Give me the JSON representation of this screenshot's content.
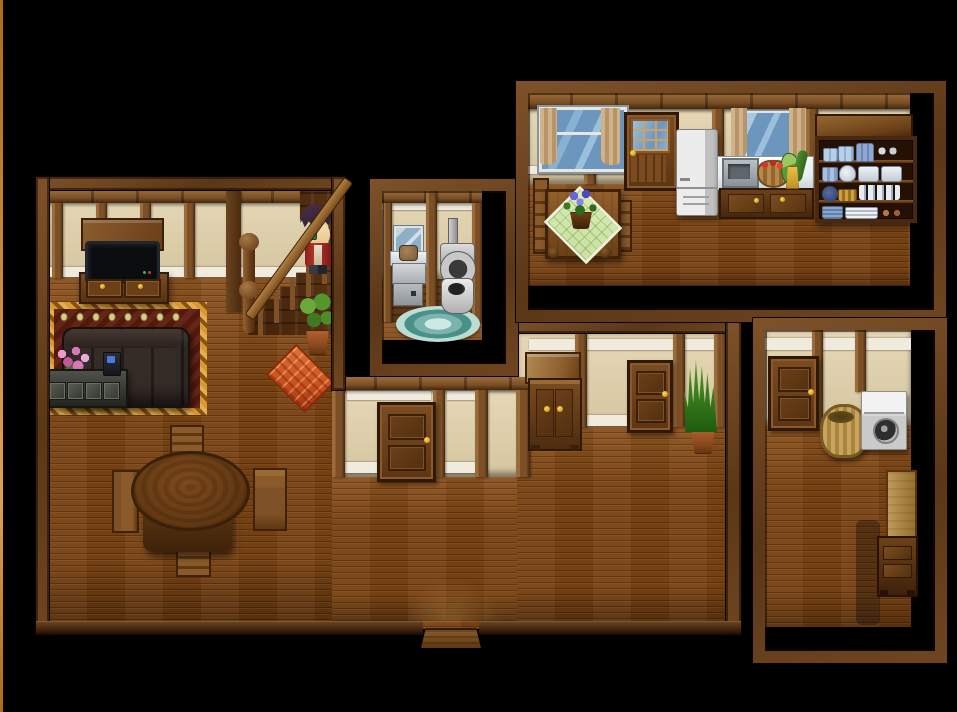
{
  "scene": {
    "type": "rpg-top-down-interior",
    "description": "Top-down RPG house interior map on black void: living room with staircase and character, small bathroom, kitchen, hallway room and laundry room",
    "character": {
      "name": "hero",
      "facing": "left",
      "hair_color": "#3f2a3c",
      "jacket_color": "#ab2d26",
      "skin_color": "#efcf9e",
      "eye_color": "#3f9a50",
      "location": "top-of-staircase"
    }
  },
  "palette": {
    "floor": "#7a4313",
    "floor_hi": "#8d5420",
    "wall": "#e6d8b6",
    "wall_dark": "#d5c6a1",
    "stripe": "#f0ebdc",
    "beam": "#7b5026",
    "beam_hi": "#9a6c3a",
    "beam_dark": "#46280e",
    "frame_hi": "#7e5229",
    "frame_mid": "#5a3718",
    "frame_low": "#6f4520",
    "wainscot": "#5c3716",
    "bath_floor": "#8a5526",
    "edge_strip": "#d0893a",
    "rug_gold": "#c8891f",
    "rug_red": "#5e1d10",
    "rug_motif": "#d9ca8b",
    "diamond_rug": "#c85020",
    "couch": "#2c2522",
    "tv_screen": "#0b0c10",
    "window_glass": "#6d96bf",
    "curtain": "#c9a97e",
    "appliance_white": "#d9d9d9",
    "counter_white": "#e9eef2",
    "teal_rug": "#4f948c",
    "wicker": "#c1a05f",
    "mat_green": "#c8e0a0",
    "plant_green": "#55952e",
    "gold": "#e8b52a"
  },
  "rooms": [
    {
      "id": "living-room",
      "label": "living room",
      "furniture": [
        "tv-hutch",
        "television",
        "tv-stand",
        "ornate-rug",
        "sofa",
        "pink-flower-planter",
        "drawer-cabinet",
        "radio-device",
        "staircase",
        "banister",
        "newel-post",
        "hero-character",
        "potted-bush",
        "diamond-rug",
        "round-dining-table",
        "dining-chair",
        "dining-chair",
        "dining-chair",
        "dining-chair"
      ]
    },
    {
      "id": "bathroom",
      "label": "bathroom",
      "furniture": [
        "mirror",
        "washbasin",
        "vanity-cabinet",
        "toilet",
        "oval-bath-rug"
      ]
    },
    {
      "id": "kitchen",
      "label": "kitchen",
      "furniture": [
        "window-left",
        "curtains",
        "flower-cart-table",
        "green-quilt-mat",
        "blue-flower-pot",
        "glass-pane-door",
        "refrigerator",
        "sink-counter",
        "kitchen-sink",
        "tomato-basket",
        "vegetables",
        "dish-shelf"
      ]
    },
    {
      "id": "hallway-room",
      "label": "middle hallway room",
      "furniture": [
        "hall-door",
        "junction-crate",
        "hall-cabinet",
        "snake-plant",
        "floor-step"
      ]
    },
    {
      "id": "laundry-room",
      "label": "laundry room",
      "furniture": [
        "laundry-door",
        "wicker-basket",
        "washing-machine",
        "tall-stool-desk"
      ]
    }
  ],
  "connector": {
    "id": "lower-hall",
    "label": "lower hall",
    "furniture": [
      "hall-door-lower",
      "entry-step"
    ]
  }
}
